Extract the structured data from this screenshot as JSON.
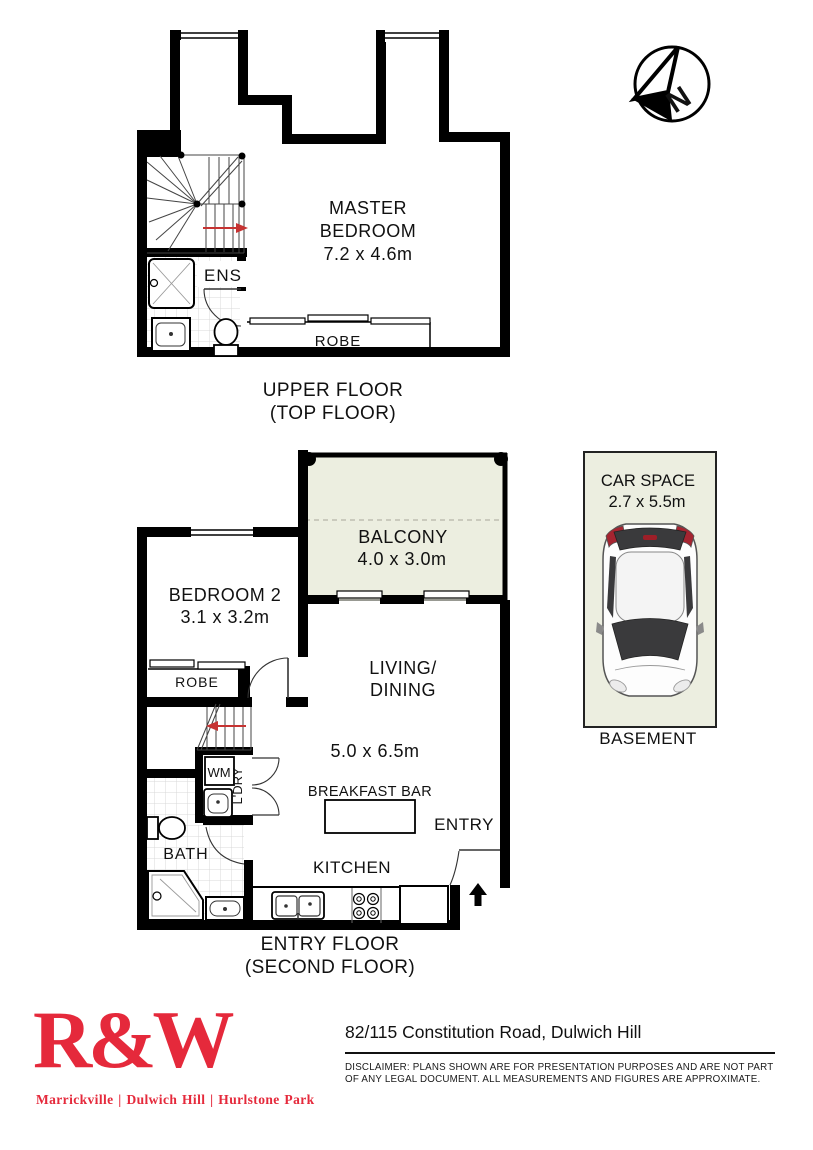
{
  "compass": {
    "letter": "N"
  },
  "upper_floor": {
    "caption_line1": "UPPER FLOOR",
    "caption_line2": "(TOP FLOOR)",
    "master_line1": "MASTER",
    "master_line2": "BEDROOM",
    "master_size": "7.2 x 4.6m",
    "ens_label": "ENS",
    "robe_label": "ROBE"
  },
  "entry_floor": {
    "caption_line1": "ENTRY FLOOR",
    "caption_line2": "(SECOND FLOOR)",
    "balcony_label": "BALCONY",
    "balcony_size": "4.0 x 3.0m",
    "bedroom2_label": "BEDROOM 2",
    "bedroom2_size": "3.1 x 3.2m",
    "robe_label": "ROBE",
    "living_line1": "LIVING/",
    "living_line2": "DINING",
    "living_size": "5.0 x 6.5m",
    "breakfast_bar_label": "BREAKFAST BAR",
    "kitchen_label": "KITCHEN",
    "entry_label": "ENTRY",
    "bath_label": "BATH",
    "wm_label": "WM",
    "laundry_label": "L'DRY"
  },
  "car_space": {
    "label_line1": "CAR SPACE",
    "label_line2": "2.7 x 5.5m",
    "caption": "BASEMENT"
  },
  "footer": {
    "brand": "R&W",
    "offices": "Marrickville | Dulwich Hill | Hurlstone Park",
    "address": "82/115 Constitution Road, Dulwich Hill",
    "disclaimer_line1": "DISCLAIMER:  PLANS SHOWN ARE FOR PRESENTATION PURPOSES AND ARE NOT PART",
    "disclaimer_line2": "OF ANY LEGAL DOCUMENT. ALL MEASUREMENTS AND FIGURES ARE APPROXIMATE.",
    "brand_color": "#e5293b"
  },
  "colors": {
    "wall": "#000000",
    "balcony_fill": "#eceee0",
    "carspace_fill": "#eceee0",
    "arrow_red": "#c63332",
    "tile_line": "#d9d9d9"
  }
}
